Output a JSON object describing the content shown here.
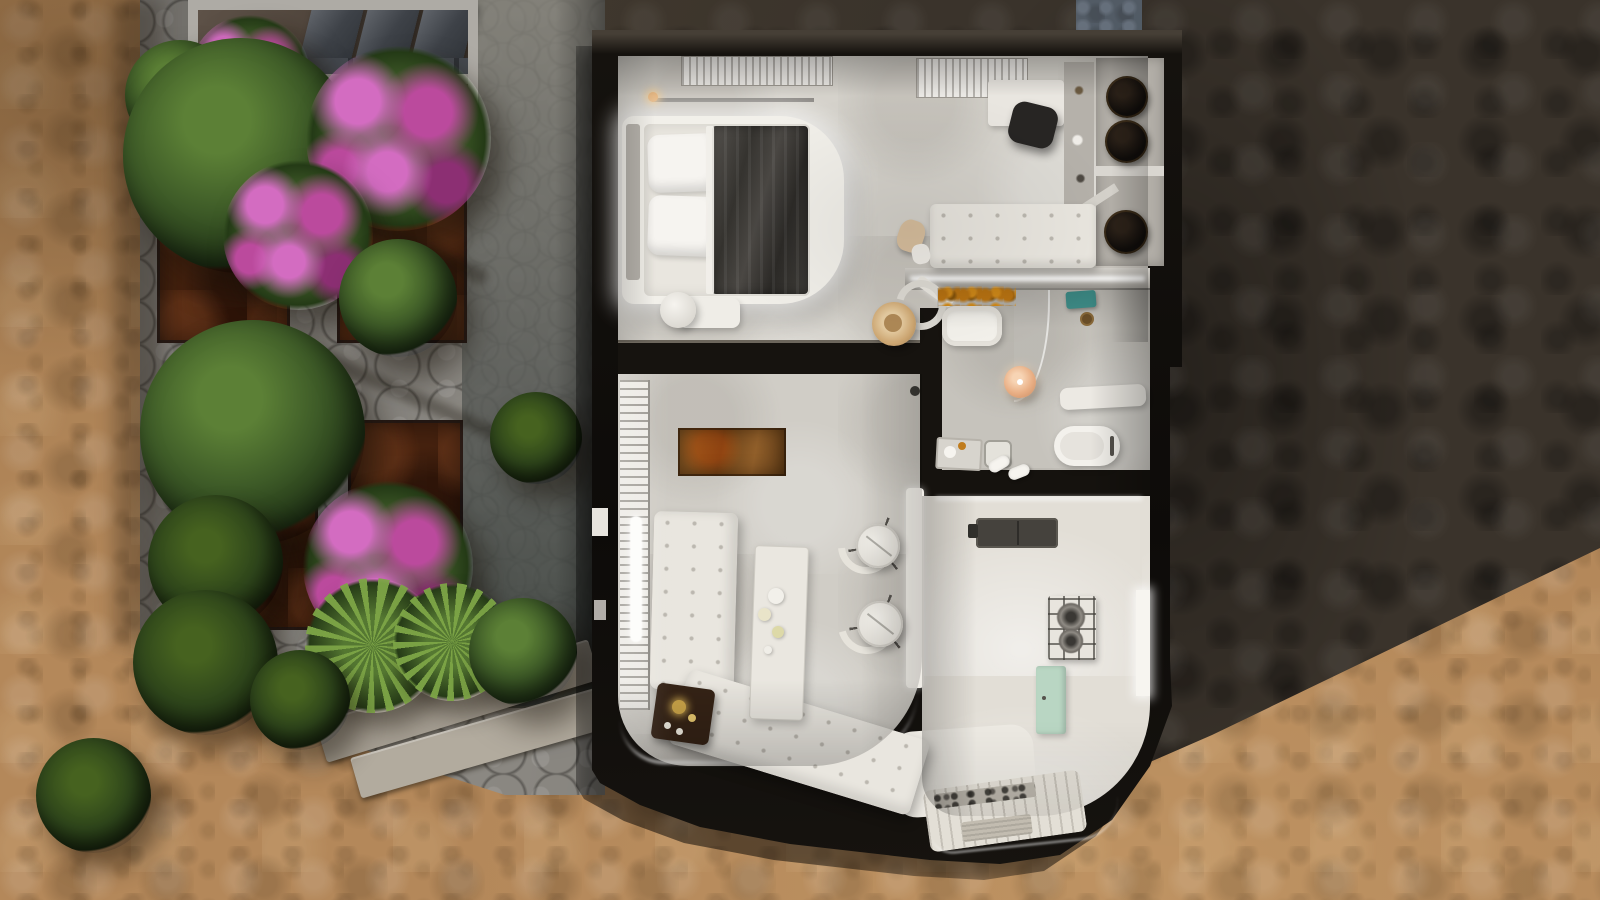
{
  "scene_type": "top-down 3D architectural floor plan render of a villa apartment",
  "palette": {
    "sand": "#b4885a",
    "sand-light": "#cda26c",
    "sand-dark": "#8a6742",
    "rock": "#3a332b",
    "rock-light": "#4c4034",
    "rock-dark": "#26211c",
    "stone": "#8c8983",
    "stone-light": "#a5a29b",
    "stone-dark": "#6e6c66",
    "planter": "#46220f",
    "planter-light": "#653317",
    "planter-dark": "#2a1309",
    "leaf": "#3d5a27",
    "leaf-light": "#5c8036",
    "leaf-dark": "#203316",
    "palm": "#6f9a42",
    "flower": "#bb4a9d",
    "flower-light": "#d36cc1",
    "flower-dark": "#8c2f73",
    "wall": "#0e0c0a",
    "wall-hi": "#463f36",
    "floor-upper": "#d5d2cb",
    "floor-living": "#d0cdc6",
    "floor-bath": "#c6c3bc",
    "floor-kitchen": "#e2ded6",
    "white": "#f2f0ea",
    "cream": "#e9e6df",
    "blanket": "#45423f",
    "bronze": "#7c4e20",
    "mint": "#b9d6c3",
    "teal": "#3f8f8a",
    "amber": "#c07c1d",
    "peach": "#e9af85",
    "straw": "#d6b183",
    "gold": "#c9a348"
  },
  "legend": {
    "terrain": [
      "sunlit sandy ground",
      "stone garden path with corten planters",
      "shadowed rock slope (right)",
      "neighbouring terrace with awnings (top-left)"
    ],
    "rooms": [
      "bedroom",
      "dressing-hall with desk and wardrobe",
      "bathroom",
      "living-dining room",
      "kitchen",
      "curved entry with deck"
    ],
    "furniture": [
      "double bed with lit platform",
      "ceiling slat vents",
      "desk with chair",
      "wardrobe with three round basins",
      "tufted bench",
      "chair with straw hat",
      "vanity sink with amber flowers",
      "walk-in shower with glass",
      "pendant sphere lamp",
      "toilet",
      "toiletry tray and towels",
      "sheer curtains",
      "bronze rug",
      "L-shaped tufted sofa",
      "dark side table with gold decor",
      "long coffee table with dishes",
      "two round cafe tables with curved chairs",
      "bar counter",
      "kitchen sink",
      "gas cooktop",
      "mint cabinet",
      "doormat on plank deck"
    ]
  },
  "planters": [
    {
      "x": 157,
      "y": 70,
      "w": 133,
      "h": 273
    },
    {
      "x": 337,
      "y": 75,
      "w": 130,
      "h": 268
    },
    {
      "x": 198,
      "y": 348,
      "w": 120,
      "h": 282
    },
    {
      "x": 348,
      "y": 420,
      "w": 115,
      "h": 253
    }
  ],
  "steps": [
    {
      "x": 282,
      "y": 645,
      "w": 265,
      "h": 40,
      "r": -17,
      "c": "#968f84"
    },
    {
      "x": 315,
      "y": 680,
      "w": 285,
      "h": 42,
      "r": -17,
      "c": "#a59e92"
    },
    {
      "x": 350,
      "y": 716,
      "w": 300,
      "h": 42,
      "r": -16,
      "c": "#b2ab9e"
    }
  ],
  "plants": [
    {
      "type": "boug",
      "x": 250,
      "y": 75,
      "d": 120
    },
    {
      "type": "tree",
      "x": 180,
      "y": 95,
      "d": 110
    },
    {
      "type": "tree",
      "x": 240,
      "y": 155,
      "d": 235
    },
    {
      "type": "boug",
      "x": 398,
      "y": 138,
      "d": 185
    },
    {
      "type": "boug",
      "x": 298,
      "y": 235,
      "d": 150
    },
    {
      "type": "tree",
      "x": 398,
      "y": 298,
      "d": 118
    },
    {
      "type": "tree",
      "x": 252,
      "y": 432,
      "d": 225
    },
    {
      "type": "fern",
      "x": 536,
      "y": 438,
      "d": 92
    },
    {
      "type": "fern",
      "x": 215,
      "y": 562,
      "d": 135
    },
    {
      "type": "boug",
      "x": 388,
      "y": 566,
      "d": 170
    },
    {
      "type": "palm",
      "x": 372,
      "y": 645,
      "d": 135
    },
    {
      "type": "fern",
      "x": 205,
      "y": 662,
      "d": 145
    },
    {
      "type": "palm",
      "x": 452,
      "y": 642,
      "d": 118
    },
    {
      "type": "tree",
      "x": 523,
      "y": 652,
      "d": 108
    },
    {
      "type": "fern",
      "x": 300,
      "y": 700,
      "d": 100
    },
    {
      "type": "fern",
      "x": 93,
      "y": 795,
      "d": 115
    }
  ],
  "closet_circles": [
    {
      "x": 1106,
      "y": 76,
      "d": 42
    },
    {
      "x": 1105,
      "y": 120,
      "d": 43
    },
    {
      "x": 1104,
      "y": 210,
      "d": 44
    }
  ],
  "tree_shadows": [
    {
      "x": 200,
      "y": 210,
      "w": 300,
      "h": 16,
      "r": 24
    },
    {
      "x": 250,
      "y": 380,
      "w": 280,
      "h": 14,
      "r": 24
    },
    {
      "x": 300,
      "y": 600,
      "w": 260,
      "h": 12,
      "r": 22
    }
  ]
}
